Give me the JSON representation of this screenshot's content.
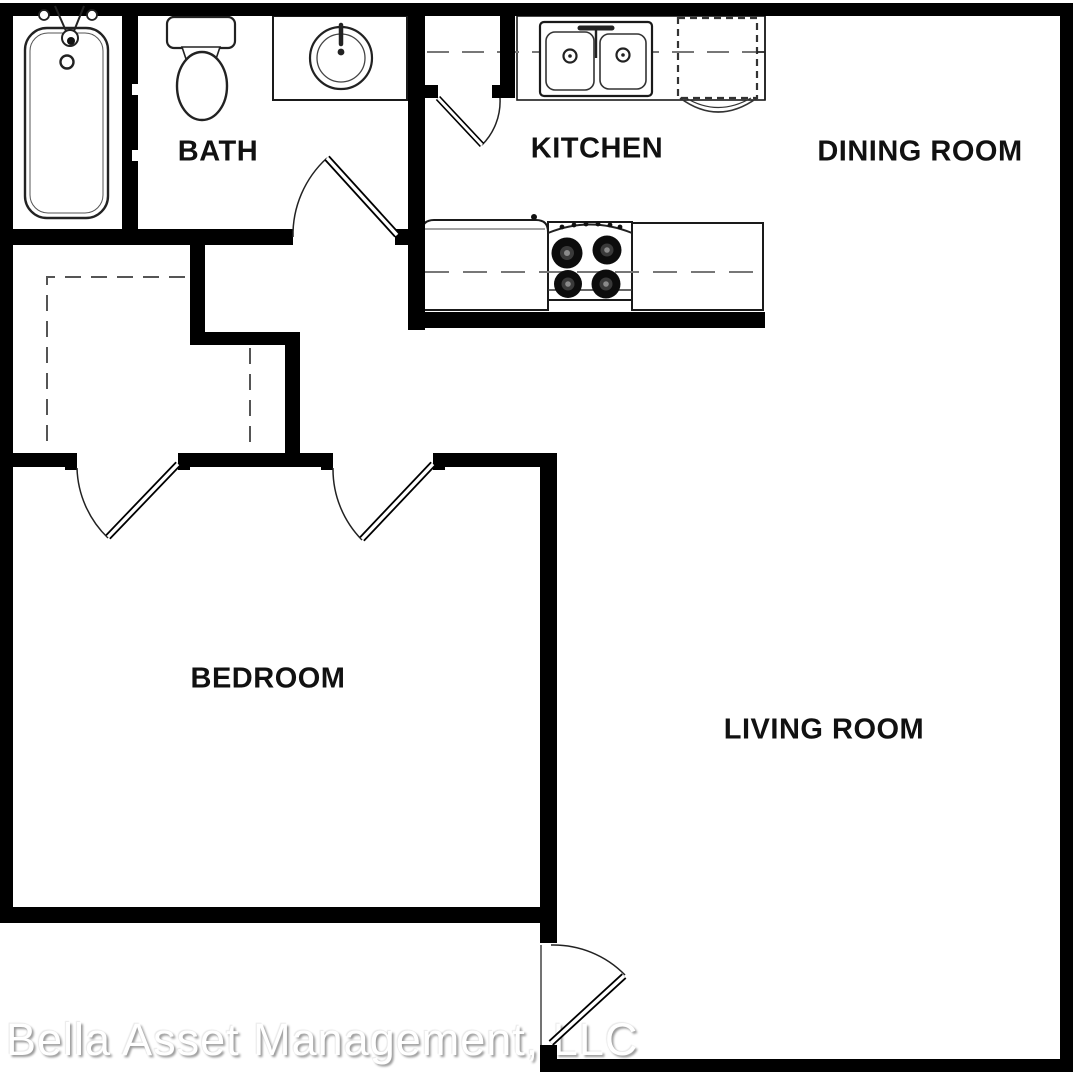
{
  "rooms": {
    "bath": {
      "label": "BATH"
    },
    "kitchen": {
      "label": "KITCHEN"
    },
    "dining": {
      "label": "DINING ROOM"
    },
    "bedroom": {
      "label": "BEDROOM"
    },
    "living": {
      "label": "LIVING ROOM"
    }
  },
  "watermark": {
    "text": "Bella Asset Management, LLC"
  },
  "colors": {
    "wall": "#000000",
    "background": "#ffffff",
    "fixture_line": "#1a1a1a",
    "dashed_line": "#777777",
    "watermark_text": "#ffffff",
    "watermark_shadow": "#9a9a9a"
  },
  "fixtures": [
    "bathtub",
    "toilet",
    "vanity-sink",
    "kitchen-double-sink",
    "refrigerator-dashed",
    "stove-four-burners",
    "kitchen-counters",
    "closet-rod-dashes"
  ],
  "doors": [
    "bath-door",
    "pantry-door",
    "closet-door",
    "bedroom-door",
    "entry-door"
  ]
}
